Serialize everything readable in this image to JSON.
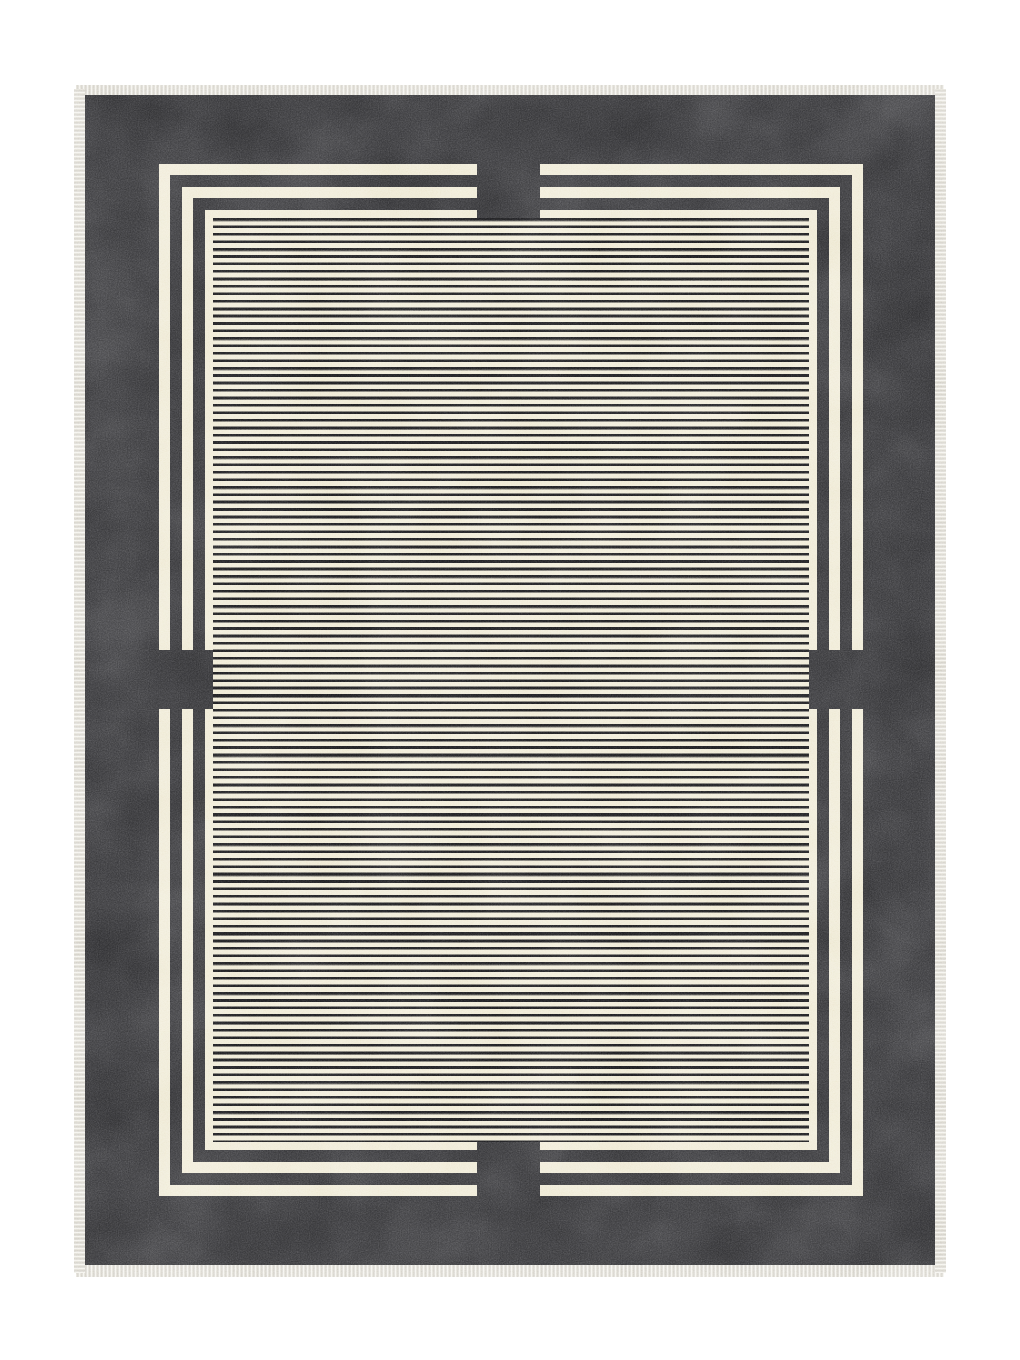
{
  "image": {
    "type": "product-photo",
    "subject": "Rectangular area rug photographed flat on a plain white background",
    "description": "Charcoal grey bordered rug with an ivory fringe on all four edges, a nested frame of cream and charcoal lines with square charcoal notches at the midpoint of each side, and a cream center panel covered in thin horizontal charcoal pinstripes"
  },
  "rug": {
    "colors": {
      "page-bg": "#ffffff",
      "field": "#4a4a4d",
      "cream": "#f2eedd",
      "stripe": "#2b2b2e",
      "fringe-base": "#e9e7e0",
      "fringe-thread": "#d2cfc8",
      "fringe-highlight": "#f7f6f2"
    },
    "features": {
      "border": "solid mottled charcoal band",
      "frame_lines": [
        "cream",
        "charcoal",
        "cream",
        "charcoal"
      ],
      "center_pattern": "horizontal charcoal pinstripes on cream",
      "notches": [
        "top-center",
        "bottom-center",
        "left-middle",
        "right-middle"
      ],
      "edges": "ivory fringe on all four sides"
    }
  }
}
